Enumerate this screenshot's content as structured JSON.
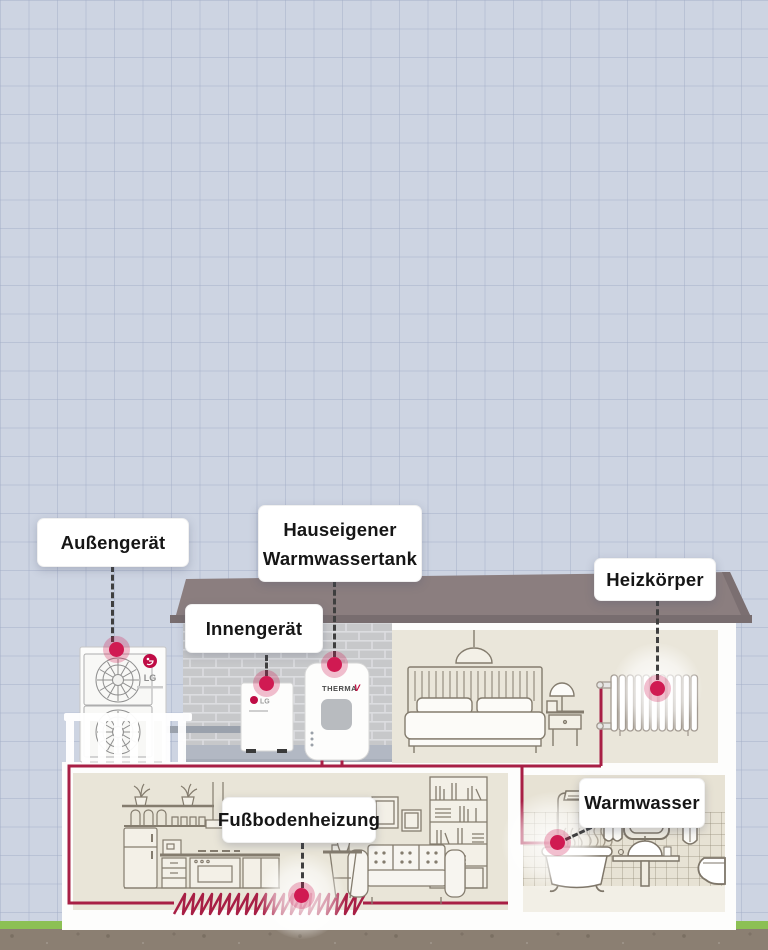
{
  "labels": {
    "outdoor_unit": "Außengerät",
    "indoor_unit": "Innengerät",
    "water_tank_line1": "Hauseigener",
    "water_tank_line2": "Warmwassertank",
    "radiator": "Heizkörper",
    "underfloor_heating": "Fußbodenheizung",
    "hot_water": "Warmwasser"
  },
  "branding": {
    "lg": "LG",
    "therma": "THERMA",
    "therma_v_suffix": "V"
  },
  "palette": {
    "background": "#cdd4e2",
    "grid_line": "#b9c2d4",
    "hotspot_red": "#d01a52",
    "pipe_red": "#a81f45",
    "roof": "#8b7e7f",
    "brick_wall": "#c7c8ca",
    "room_beige": "#e9e5d8",
    "furniture_line": "#847c6e",
    "ground_brown": "#8b7f72",
    "grass_green": "#8cc054",
    "lg_logo_red": "#bf0c45"
  }
}
